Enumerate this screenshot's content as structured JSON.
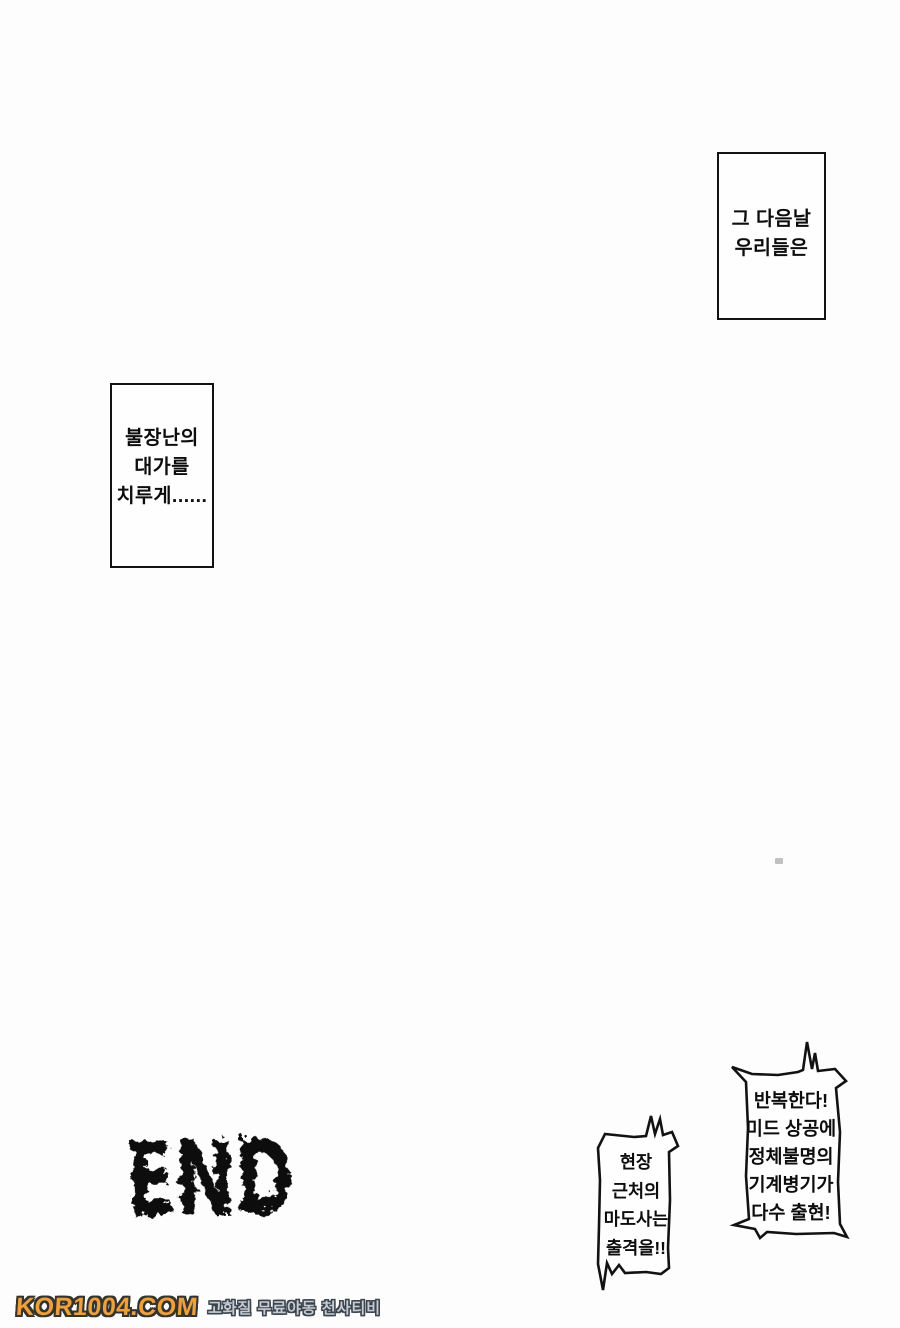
{
  "page": {
    "background": "#fdfdfd",
    "ink_color": "#121212"
  },
  "panels": {
    "caption_next_day": {
      "lines": [
        "그 다음날",
        "우리들은"
      ]
    },
    "caption_price": {
      "lines": [
        "불장난의",
        "대가를",
        "치루게......"
      ]
    },
    "bubble_alert": {
      "lines": [
        "반복한다!",
        "미드 상공에",
        "정체불명의",
        "기계병기가",
        "다수 출현!"
      ]
    },
    "bubble_dispatch": {
      "lines": [
        "현장",
        "근처의",
        "마도사는",
        "출격을!!"
      ]
    },
    "end_label": "END"
  },
  "watermark": {
    "site": "KOR1004.COM",
    "tagline": "고화질 무료야동 천사티비",
    "site_color": "#eda03d",
    "tagline_color": "#c7cad0",
    "outline_color": "#36332c"
  }
}
